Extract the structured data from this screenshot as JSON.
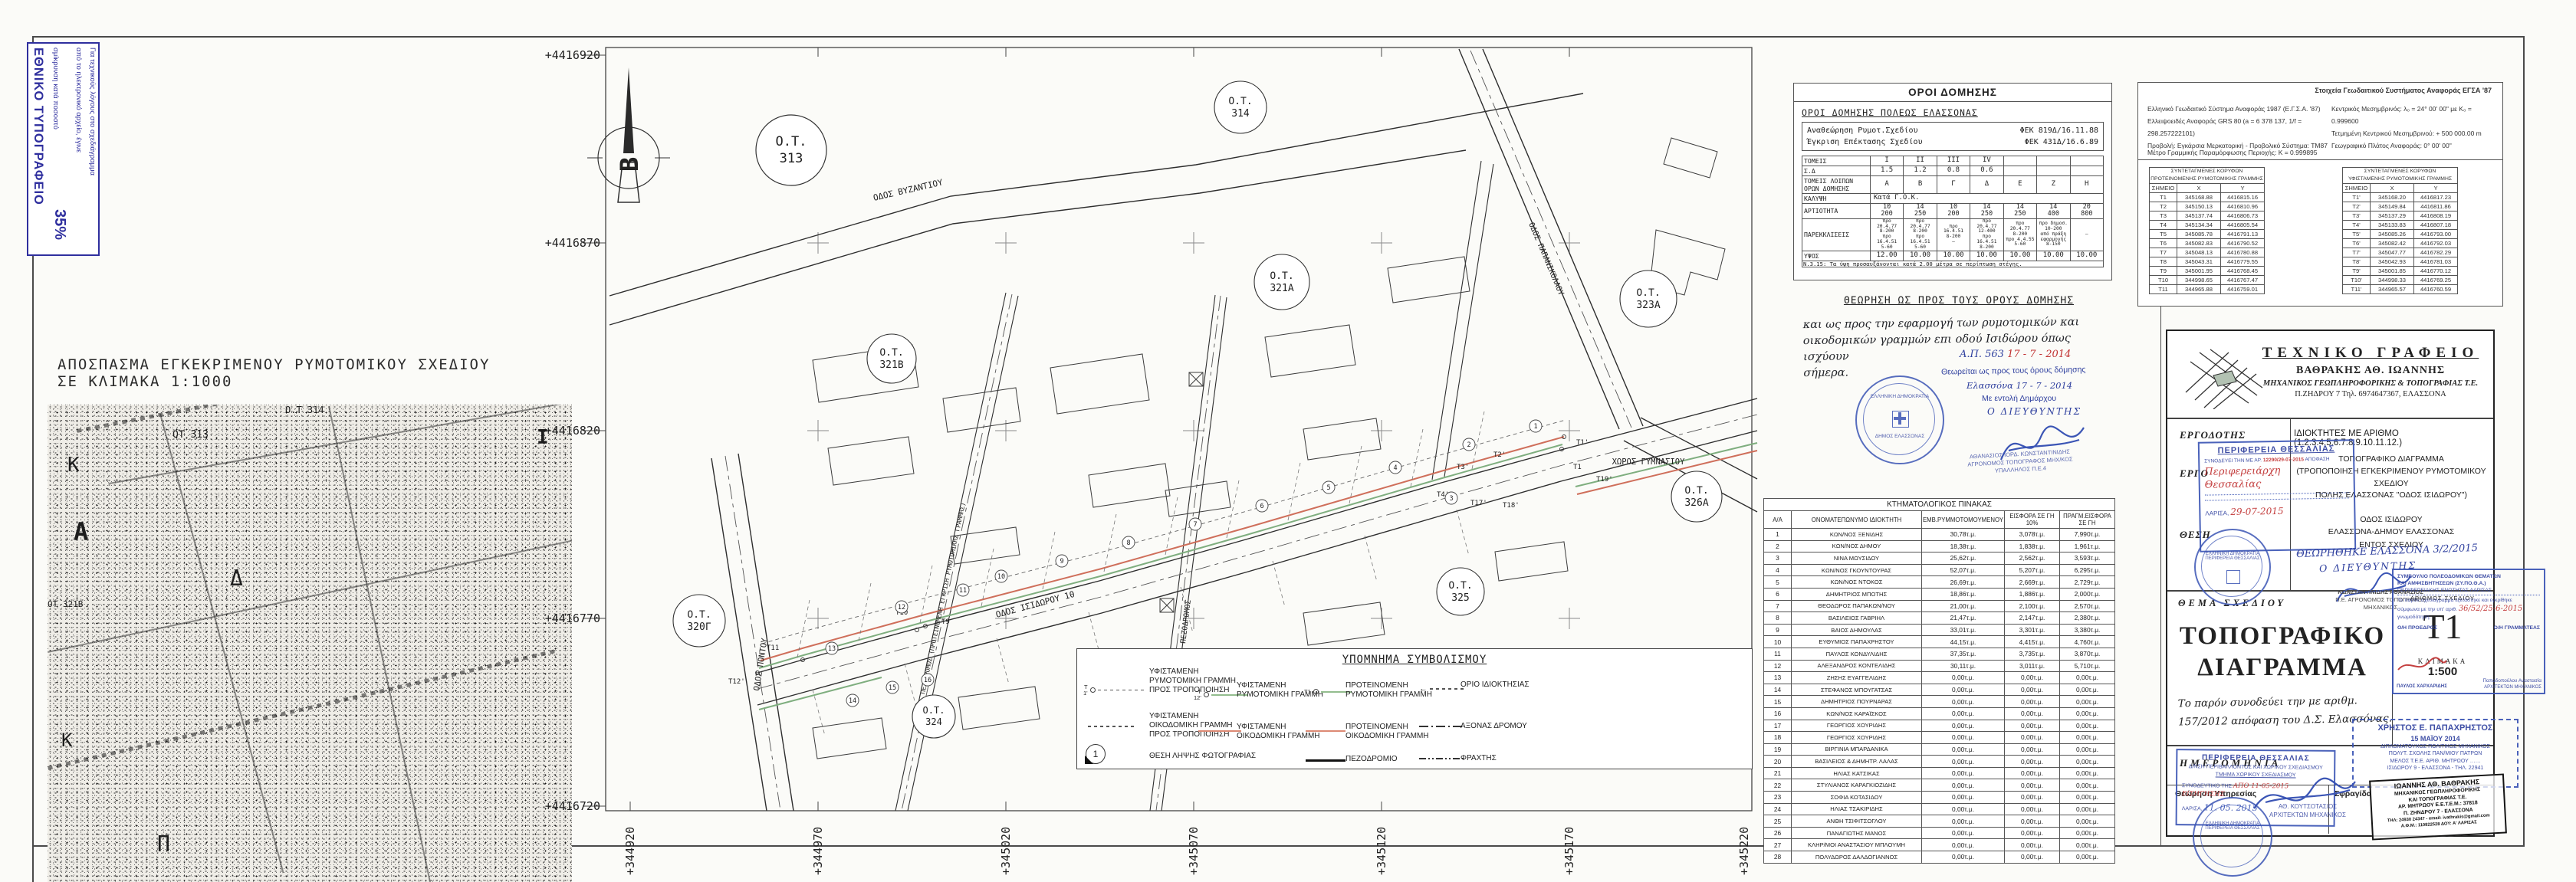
{
  "print_stamp": {
    "title": "ΕΘΝΙΚΟ ΤΥΠΟΓΡΑΦΕΙΟ",
    "line1": "Για τεχνικούς λόγους στο σχεδιάγραμμα",
    "line2": "από το ηλεκτρονικό αρχείο, έγινε",
    "line3": "σμίκρυνση κατά ποσοστό",
    "percent": "35%"
  },
  "excerpt": {
    "title": "ΑΠΟΣΠΑΣΜΑ ΕΓΚΕΚΡΙΜΕΝΟΥ ΡΥΜΟΤΟΜΙΚΟΥ ΣΧΕΔΙΟΥ",
    "subtitle": "ΣΕ ΚΛΙΜΑΚΑ 1:1000",
    "labels": [
      "ΟΤ 313",
      "Ο.Τ 314",
      "ΟΤ 321Β",
      "Κ",
      "Α",
      "Δ",
      "Κ",
      "Π",
      "Ι"
    ]
  },
  "plan": {
    "north": "Β",
    "y_labels": [
      "+4416920",
      "+4416870",
      "+4416820",
      "+4416770",
      "+4416720"
    ],
    "x_labels": [
      "+344920",
      "+344970",
      "+345020",
      "+345070",
      "+345120",
      "+345170",
      "+345220"
    ],
    "blocks": [
      {
        "l1": "Ο.Τ.",
        "l2": "313"
      },
      {
        "l1": "Ο.Τ.",
        "l2": "314"
      },
      {
        "l1": "Ο.Τ.",
        "l2": "321Α"
      },
      {
        "l1": "Ο.Τ.",
        "l2": "321Β"
      },
      {
        "l1": "Ο.Τ.",
        "l2": "323Α"
      },
      {
        "l1": "Ο.Τ.",
        "l2": "326Α"
      },
      {
        "l1": "Ο.Τ.",
        "l2": "320Γ"
      },
      {
        "l1": "Ο.Τ.",
        "l2": "325"
      },
      {
        "l1": "Ο.Τ.",
        "l2": "324"
      }
    ],
    "streets": {
      "vyzantiou": "ΟΔΟΣ ΒΥΖΑΝΤΙΟΥ",
      "isidorou": "ΟΔΟΣ ΙΣΙΔΩΡΟΥ 10",
      "pontou": "ΟΔΟΣ ΠΟΝΤΟΥ",
      "papanikolaou": "ΟΔΟΣ ΠΑΠΑΝΙΚΟΛΑΟΥ",
      "pezodromos": "ΠΕΖΟΔΡΟΜΟΣ",
      "pezodromos_long": "ΠΕΖΟΔΡΟΜΟΣ (ΠΡΟΤΕΙΝΟΜΕΝΗ ΕΓΚΡΙΣΗ ΡΥΜΟΤΟΜΙΚΗΣ ΓΡΑΜΜΗΣ)",
      "gymnasiou": "ΧΩΡΟΣ ΓΥΜΝΑΣΙΟΥ"
    },
    "points": [
      "Τ1",
      "Τ1'",
      "Τ2'",
      "Τ3'",
      "Τ4'",
      "Τ9",
      "Τ10",
      "Τ11",
      "Τ12'",
      "Τ17'",
      "Τ18'",
      "Τ19'"
    ],
    "parcels": [
      "1",
      "2",
      "3",
      "4",
      "5",
      "6",
      "7",
      "8",
      "9",
      "10",
      "11",
      "12",
      "13",
      "14",
      "15",
      "16"
    ]
  },
  "legend": {
    "title": "ΥΠΟΜΝΗΜΑ ΣΥΜΒΟΛΙΣΜΟΥ",
    "items": [
      {
        "pre": "Τ\n1'",
        "label": "ΥΦΙΣΤΑΜΕΝΗ\nΡΥΜΟΤΟΜΙΚΗ ΓΡΑΜΜΗ\nΠΡΟΣ ΤΡΟΠΟΠΟΙΗΣΗ"
      },
      {
        "label": "ΥΦΙΣΤΑΜΕΝΗ\nΟΙΚΟΔΟΜΙΚΗ ΓΡΑΜΜΗ\nΠΡΟΣ ΤΡΟΠΟΠΟΙΗΣΗ"
      },
      {
        "badge": "1",
        "label": "ΘΕΣΗ ΛΗΨΗΣ ΦΩΤΟΓΡΑΦΙΑΣ"
      },
      {
        "pre": "Τ\n12'",
        "label": "ΥΦΙΣΤΑΜΕΝΗ\nΡΥΜΟΤΟΜΙΚΗ ΓΡΑΜΜΗ"
      },
      {
        "label": "ΥΦΙΣΤΑΜΕΝΗ\nΟΙΚΟΔΟΜΙΚΗ ΓΡΑΜΜΗ"
      },
      {
        "pre": "Τ1",
        "label": "ΠΡΟΤΕΙΝΟΜΕΝΗ\nΡΥΜΟΤΟΜΙΚΗ ΓΡΑΜΜΗ"
      },
      {
        "label": "ΠΡΟΤΕΙΝΟΜΕΝΗ\nΟΙΚΟΔΟΜΙΚΗ ΓΡΑΜΜΗ"
      },
      {
        "label": "ΠΕΖΟΔΡΟΜΙΟ"
      },
      {
        "label": "ΟΡΙΟ ΙΔΙΟΚΤΗΣΙΑΣ"
      },
      {
        "label": "ΑΞΟΝΑΣ ΔΡΟΜΟΥ"
      },
      {
        "label": "ΦΡΑΧΤΗΣ"
      }
    ]
  },
  "terms": {
    "box_title": "ΟΡΟΙ ΔΟΜΗΣΗΣ",
    "subtitle": "ΟΡΟΙ ΔΟΜΗΣΗΣ ΠΟΛΕΩΣ ΕΛΑΣΣΟΝΑΣ",
    "fek": [
      {
        "label": "Αναθεώρηση Ρυμοτ.Σχεδίου",
        "value": "ΦΕΚ 819Δ/16.11.88"
      },
      {
        "label": "Έγκριση Επέκτασης Σχεδίου",
        "value": "ΦΕΚ 431Δ/16.6.89"
      }
    ],
    "kalypsi_label": "ΚΑΛΥΨΗ",
    "kalypsi_value": "Κατά Γ.Ο.Κ.",
    "table": {
      "rows": [
        {
          "label": "ΤΟΜΕΙΣ",
          "values": [
            "Ι",
            "ΙΙ",
            "ΙΙΙ",
            "ΙV",
            "",
            "",
            ""
          ]
        },
        {
          "label": "Σ.Δ",
          "values": [
            "1.5",
            "1.2",
            "0.8",
            "0.6",
            "",
            "",
            ""
          ]
        },
        {
          "label": "ΤΟΜΕΙΣ ΛΟΙΠΩΝ\nΟΡΩΝ ΔΟΜΗΣΗΣ",
          "values": [
            "Α",
            "Β",
            "Γ",
            "Δ",
            "Ε",
            "Ζ",
            "Η"
          ]
        },
        {
          "label": "ΑΡΤΙΟΤΗΤΑ",
          "values": [
            "10\n200",
            "14\n250",
            "10\n200",
            "14\n250",
            "14\n250",
            "14\n400",
            "20\n800"
          ]
        },
        {
          "label": "ΠΑΡΕΚΚΛΙΣΕΙΣ",
          "values": [
            "προ 20.4.77\n8-200\nπρο 16.4.51\n5-60",
            "προ 20.4.77\n8-200\nπρο 16.4.51\n5-60",
            "προ 16.4.51\n8-200\n–",
            "προ 20.4.77\n12-400\nπρο 16.4.51\n8-200",
            "προ 20.4.77\n8-200\nπρο 4.4.55\n5-60",
            "προ δημοσ.\n10-200\nαπό πράξη εφαρμογής\n8-150",
            "–"
          ]
        },
        {
          "label": "ΥΨΟΣ",
          "values": [
            "12.00",
            "10.00",
            "10.00",
            "10.00",
            "10.00",
            "10.00",
            "10.00"
          ]
        }
      ]
    },
    "footnote": "Ν.3.15: Τα ύψη προσαυξάνονται κατά 2.00 μέτρα σε περίπτωση στέγης."
  },
  "geo": {
    "title": "Στοιχεία Γεωδαιτικού Συστήματος Αναφοράς ΕΓΣΑ '87",
    "left": [
      "Ελληνικό Γεωδαιτικό Σύστημα Αναφοράς 1987 (Ε.Γ.Σ.Α. '87)",
      "Ελλειψοειδές Αναφοράς GRS 80 (a = 6 378 137, 1/f = 298.257222101)",
      "Προβολή: Εγκάρσια Μερκατορική - Προβολικό Σύστημα: ΤΜ87"
    ],
    "right": [
      "Κεντρικός Μεσημβρινός: λ₀ = 24° 00' 00\" με Κ₀ = 0.999600",
      "Τετμημένη Κεντρικού Μεσημβρινού: + 500 000.00 m",
      "Γεωγραφικό Πλάτος Αναφοράς: 0° 00' 00\""
    ],
    "metro": "Μέτρο Γραμμικής Παραμόρφωσης Περιοχής: Κ = 0.999895"
  },
  "coords": {
    "a": {
      "t1": "ΣΥΝΤΕΤΑΓΜΕΝΕΣ ΚΟΡΥΦΩΝ",
      "t2": "ΠΡΟΤΕΙΝΟΜΕΝΗΣ ΡΥΜΟΤΟΜΙΚΗΣ ΓΡΑΜΜΗΣ",
      "headers": [
        "ΣΗΜΕΙΟ",
        "Χ",
        "Υ"
      ],
      "rows": [
        [
          "Τ1",
          "345168.88",
          "4416815.16"
        ],
        [
          "Τ2",
          "345150.13",
          "4416810.96"
        ],
        [
          "Τ3",
          "345137.74",
          "4416806.73"
        ],
        [
          "Τ4",
          "345134.34",
          "4416805.54"
        ],
        [
          "Τ5",
          "345085.78",
          "4416791.13"
        ],
        [
          "Τ6",
          "345082.83",
          "4416790.52"
        ],
        [
          "Τ7",
          "345048.13",
          "4416780.88"
        ],
        [
          "Τ8",
          "345043.31",
          "4416779.55"
        ],
        [
          "Τ9",
          "345001.95",
          "4416768.45"
        ],
        [
          "Τ10",
          "344998.65",
          "4416767.47"
        ],
        [
          "Τ11",
          "344965.88",
          "4416759.01"
        ]
      ]
    },
    "b": {
      "t1": "ΣΥΝΤΕΤΑΓΜΕΝΕΣ ΚΟΡΥΦΩΝ",
      "t2": "ΥΦΙΣΤΑΜΕΝΗΣ ΡΥΜΟΤΟΜΙΚΗΣ ΓΡΑΜΜΗΣ",
      "headers": [
        "ΣΗΜΕΙΟ",
        "Χ",
        "Υ"
      ],
      "rows": [
        [
          "Τ1'",
          "345168.20",
          "4416817.23"
        ],
        [
          "Τ2'",
          "345149.84",
          "4416811.86"
        ],
        [
          "Τ3'",
          "345137.29",
          "4416808.19"
        ],
        [
          "Τ4'",
          "345133.83",
          "4416807.18"
        ],
        [
          "Τ5'",
          "345085.26",
          "4416793.00"
        ],
        [
          "Τ6'",
          "345082.42",
          "4416792.03"
        ],
        [
          "Τ7'",
          "345047.77",
          "4416782.29"
        ],
        [
          "Τ8'",
          "345042.93",
          "4416781.03"
        ],
        [
          "Τ9'",
          "345001.85",
          "4416770.12"
        ],
        [
          "Τ10'",
          "344998.33",
          "4416769.25"
        ],
        [
          "Τ11'",
          "344965.57",
          "4416760.59"
        ]
      ]
    }
  },
  "theorisi": {
    "title": "ΘΕΩΡΗΣΗ  ΩΣ ΠΡΟΣ ΤΟΥΣ ΟΡΟΥΣ ΔΟΜΗΣΗΣ",
    "note": "και ως προς την εφαρμογή των ρυμοτομικών και\nοικοδομικών γραμμών επι οδού Ισιδώρου όπως ισχύουν\nσήμερα.",
    "ap": "Α.Π. 563",
    "ap_date": "17 - 7 - 2014",
    "line1": "Θεωρείται ως προς τους όρους δόμησης",
    "line2": "Ελασσόνα 17 - 7 - 2014",
    "line3": "Με εντολή Δημάρχου",
    "line4": "Ο ΔΙΕΥΘΥΝΤΗΣ",
    "stamp_line1": "ΕΛΛΗΝΙΚΗ ΔΗΜΟΚΡΑΤΙΑ",
    "stamp_line2": "ΔΗΜΟΣ ΕΛΑΣΣΟΝΑΣ",
    "officer1": "ΑΘΑΝΑΣΙΟΣ ΙΟΡΔ. ΚΩΝΣΤΑΝΤΙΝΙΔΗΣ",
    "officer2": "ΑΓΡΟΝΟΜΟΣ ΤΟΠΟΓΡΑΦΟΣ ΜΗΧ/ΚΟΣ",
    "officer3": "ΥΠΑΛΛΗΛΟΣ Π.Ε.4"
  },
  "cadastral": {
    "title": "ΚΤΗΜΑΤΟΛΟΓΙΚΟΣ ΠΙΝΑΚΑΣ",
    "headers": [
      "Α/Α",
      "ΟΝΟΜΑΤΕΠΩΝΥΜΟ ΙΔΙΟΚΤΗΤΗ",
      "ΕΜΒ.ΡΥΜΜΟΤΟΜΟΥΜΕΝΟΥ",
      "ΕΙΣΦΟΡΑ ΣΕ ΓΗ 10%",
      "ΠΡΑΓΜ.ΕΙΣΦΟΡΑ ΣΕ ΓΗ"
    ],
    "rows": [
      [
        "1",
        "ΚΩΝ/ΝΟΣ ΞΕΝΙΔΗΣ",
        "30,78τ.μ.",
        "3,078τ.μ.",
        "7,990τ.μ."
      ],
      [
        "2",
        "ΚΩΝ/ΝΟΣ ΔΗΜΟΥ",
        "18,38τ.μ.",
        "1,838τ.μ.",
        "1,961τ.μ."
      ],
      [
        "3",
        "ΝΙΝΑ ΜΩΥΣΙΔΟΥ",
        "25,62τ.μ.",
        "2,562τ.μ.",
        "3,593τ.μ."
      ],
      [
        "4",
        "ΚΩΝ/ΝΟΣ ΓΚΟΥΝΤΟΥΡΑΣ",
        "52,07τ.μ.",
        "5,207τ.μ.",
        "6,295τ.μ."
      ],
      [
        "5",
        "ΚΩΝ/ΝΟΣ ΝΤΟΚΟΣ",
        "26,69τ.μ.",
        "2,669τ.μ.",
        "2,729τ.μ."
      ],
      [
        "6",
        "ΔΗΜΗΤΡΙΟΣ ΜΠΟΤΗΣ",
        "18,86τ.μ.",
        "1,886τ.μ.",
        "2,000τ.μ."
      ],
      [
        "7",
        "ΘΕΟΔΩΡΟΣ ΠΑΠΑΚΩΝ/ΝΟΥ",
        "21,00τ.μ.",
        "2,100τ.μ.",
        "2,570τ.μ."
      ],
      [
        "8",
        "ΒΑΣΙΛΕΙΟΣ ΓΑΒΡΙΗΛ",
        "21,47τ.μ.",
        "2,147τ.μ.",
        "2,380τ.μ."
      ],
      [
        "9",
        "ΒΑΙΟΣ ΔΗΜΟΥΛΑΣ",
        "33,01τ.μ.",
        "3,301τ.μ.",
        "3,380τ.μ."
      ],
      [
        "10",
        "ΕΥΘΥΜΙΟΣ ΠΑΠΑΧΡΗΣΤΟΥ",
        "44,15τ.μ.",
        "4,415τ.μ.",
        "4,760τ.μ."
      ],
      [
        "11",
        "ΠΑΥΛΟΣ ΚΟΝΔΥΛΙΔΗΣ",
        "37,35τ.μ.",
        "3,735τ.μ.",
        "3,870τ.μ."
      ],
      [
        "12",
        "ΑΛΕΞΑΝΔΡΟΣ ΚΟΝΤΕΛΙΔΗΣ",
        "30,11τ.μ.",
        "3,011τ.μ.",
        "5,710τ.μ."
      ],
      [
        "13",
        "ΖΗΣΗΣ ΕΥΑΓΓΕΛΙΔΗΣ",
        "0,00τ.μ.",
        "0,00τ.μ.",
        "0,00τ.μ."
      ],
      [
        "14",
        "ΣΤΕΦΑΝΟΣ ΜΠΟΥΓΑΤΣΑΣ",
        "0,00τ.μ.",
        "0,00τ.μ.",
        "0,00τ.μ."
      ],
      [
        "15",
        "ΔΗΜΗΤΡΙΟΣ ΠΟΥΡΝΑΡΑΣ",
        "0,00τ.μ.",
        "0,00τ.μ.",
        "0,00τ.μ."
      ],
      [
        "16",
        "ΚΩΝ/ΝΟΣ ΚΑΡΑΪΣΚΟΣ",
        "0,00τ.μ.",
        "0,00τ.μ.",
        "0,00τ.μ."
      ],
      [
        "17",
        "ΓΕΩΡΓΙΟΣ ΧΟΥΡΙΔΗΣ",
        "0,00τ.μ.",
        "0,00τ.μ.",
        "0,00τ.μ."
      ],
      [
        "18",
        "ΓΕΩΡΓΙΟΣ ΧΟΥΡΙΔΗΣ",
        "0,00τ.μ.",
        "0,00τ.μ.",
        "0,00τ.μ."
      ],
      [
        "19",
        "ΒΙΡΓΙΝΙΑ ΜΠΑΡΔΑΝΙΚΑ",
        "0,00τ.μ.",
        "0,00τ.μ.",
        "0,00τ.μ."
      ],
      [
        "20",
        "ΒΑΣΙΛΕΙΟΣ & ΔΗΜΗΤΡ. ΛΑΛΑΣ",
        "0,00τ.μ.",
        "0,00τ.μ.",
        "0,00τ.μ."
      ],
      [
        "21",
        "ΗΛΙΑΣ ΚΑΤΣΙΚΑΣ",
        "0,00τ.μ.",
        "0,00τ.μ.",
        "0,00τ.μ."
      ],
      [
        "22",
        "ΣΤΥΛΙΑΝΟΣ ΚΑΡΑΓΚΙΟΖΙΔΗΣ",
        "0,00τ.μ.",
        "0,00τ.μ.",
        "0,00τ.μ."
      ],
      [
        "23",
        "ΣΟΦΙΑ ΚΟΤΑΣΙΔΟΥ",
        "0,00τ.μ.",
        "0,00τ.μ.",
        "0,00τ.μ."
      ],
      [
        "24",
        "ΗΛΙΑΣ ΤΣΑΚΙΡΙΔΗΣ",
        "0,00τ.μ.",
        "0,00τ.μ.",
        "0,00τ.μ."
      ],
      [
        "25",
        "ΑΝΘΗ ΤΣΙΦΙΤΣΟΓΛΟΥ",
        "0,00τ.μ.",
        "0,00τ.μ.",
        "0,00τ.μ."
      ],
      [
        "26",
        "ΠΑΝΑΓΙΩΤΗΣ ΜΑΝΟΣ",
        "0,00τ.μ.",
        "0,00τ.μ.",
        "0,00τ.μ."
      ],
      [
        "27",
        "ΚΛΗΡ/ΜΟΙ ΑΝΑΣΤΑΣΙΟΥ ΜΠΛΟΥΜΗ",
        "0,00τ.μ.",
        "0,00τ.μ.",
        "0,00τ.μ."
      ],
      [
        "28",
        "ΠΟΛΥΔΩΡΟΣ ΔΑΛΔΟΓΙΑΝΝΟΣ",
        "0,00τ.μ.",
        "0,00τ.μ.",
        "0,00τ.μ."
      ]
    ]
  },
  "titleblock": {
    "office_title": "ΤΕΧΝΙΚΟ ΓΡΑΦΕΙΟ",
    "office_name": "ΒΑΘΡΑΚΗΣ ΑΘ. ΙΩΑΝΝΗΣ",
    "office_prof": "ΜΗΧΑΝΙΚΟΣ ΓΕΩΠΛΗΡΟΦΟΡΙΚΗΣ & ΤΟΠΟΓΡΑΦΙΑΣ Τ.Ε.",
    "office_addr": "Π.ΖΗΔΡΟΥ 7    Τηλ. 6974647367, ΕΛΑΣΣΟΝΑ",
    "ergodotis_label": "ΕΡΓΟΔΟΤΗΣ",
    "ergodotis_value": "ΙΔΙΟΚΤΗΤΕΣ  ΜΕ ΑΡΙΘΜΟ (1.2.3.4.5.6.7.8.9.10.11.12.)",
    "ergo_label": "ΕΡΓΟ",
    "ergo_l1": "ΤΟΠΟΓΡΑΦΙΚΟ ΔΙΑΓΡΑΜΜΑ",
    "ergo_l2": "(ΤΡΟΠΟΠΟΙΗΣΗ ΕΓΚΕΚΡΙΜΕΝΟΥ ΡΥΜΟΤΟΜΙΚΟΥ ΣΧΕΔΙΟΥ",
    "ergo_l3": "ΠΟΛΗΣ ΕΛΑΣΣΟΝΑΣ \"ΟΔΟΣ ΙΣΙΔΩΡΟΥ\")",
    "thesi_label": "ΘΕΣΗ",
    "thesi_l1": "ΟΔΟΣ ΙΣΙΔΩΡΟΥ",
    "thesi_l2": "ΕΛΑΣΣΟΝΑ-ΔΗΜΟΥ ΕΛΑΣΣΟΝΑΣ",
    "thesi_l3": "ΕΝΤΟΣ ΣΧΕΔΙΟΥ",
    "thema_label": "ΘΕΜΑ ΣΧΕΔΙΟΥ",
    "thema_l1": "ΤΟΠΟΓΡΑΦΙΚΟ",
    "thema_l2": "ΔΙΑΓΡΑΜΜΑ",
    "thema_note": "Το παρόν συνοδεύει την με αριθμ.\n157/2012 απόφαση του Δ.Σ. Ελασσόνας.",
    "arithmos_label": "ΑΡΙΘΜΟΣ ΣΧΕΔΙΟΥ",
    "sheet_no": "Τ1",
    "klimaka_label": "ΚΛΙΜΑΚΑ",
    "scale": "1:500",
    "imerominia_label": "ΗΜΕΡΟΜΗΝΙΑ",
    "theorisi_label": "Θεώρηση Υπηρεσίας",
    "sfragida_label": "Σφραγίδα"
  },
  "stamps": {
    "perifereia": {
      "line1": "ΠΕΡΙΦΕΡΕΙΑ ΘΕΣΣΑΛΙΑΣ",
      "line2": "ΣΥΝΟΔΕΥΕΙ ΤΗΝ ΜΕ ΑΡ.",
      "num": "12290/29-07-2015",
      "line3": "ΑΠΟΦΑΣΗ",
      "script": "Περιφερειάρχη\nΘεσσαλίας",
      "city": "ΛΑΡΙΣΑ,",
      "date": "29-07-2015"
    },
    "theorithike": {
      "line1": "ΘΕΩΡΗΘΗΚΕ ΕΛΑΣΣΟΝΑ 3/2/2015",
      "line2": "Ο ΔΙΕΥΘΥΝΤΗΣ",
      "name": "ΚΩΝΣΤΑΝΤΙΝΙΔΗΣ ΑΘΑΝΑΣΙΟΣ",
      "title": "Π.Ε. ΑΓΡΟΝΟΜΟΣ ΤΟΠΟΓΡΑΦΟΣ\nΜΗΧΑΝΙΚΟΣ"
    },
    "sypotha": {
      "line1": "ΣΥΜΒΟΥΛΙΟ ΠΟΛΕΟΔΟΜΙΚΩΝ ΘΕΜΑΤΩΝ",
      "line2": "ΚΑΙ ΑΜΦΙΣΒΗΤΗΣΕΩΝ (ΣΥ.ΠΟ.Θ.Α.)",
      "line3": "ΠΕΡΙΦΕΡΕΙΑΚΗΣ ΕΝΟΤΗΤΑΣ ΛΑΡΙΣΑΣ",
      "body1": "Το παρόν σχεδιάγραμμα εξετάστηκε και εγκρίθηκε",
      "body2": "σύμφωνα με την υπ' αριθ.",
      "num": "36/52/25-6-2015",
      "body3": "γνωμοδότηση.",
      "proedros": "Ο/Η ΠΡΟΕΔΡΟΣ",
      "grammateas": "Ο/Η ΓΡΑΜΜΑΤΕΑΣ",
      "name1": "ΠΑΥΛΟΣ ΧΑΡΧΑΡΙΔΗΣ",
      "name2": "Παπαδοπούλου Αναστασία",
      "name2b": "ΑΡΧΙΤΕΚΤΩΝ ΜΗΧΑΝΙΚΟΣ"
    },
    "ypiresia": {
      "line1": "ΠΕΡΙΦΕΡΕΙΑ ΘΕΣΣΑΛΙΑΣ",
      "line2": "Δ/ΝΣΗ ΠΕΡΙΒΑΛΛΟΝΤΟΣ ΚΑΙ ΧΩΡΙΚΟΥ ΣΧΕΔΙΑΣΜΟΥ",
      "line3": "ΤΜΗΜΑ ΧΩΡΙΚΟΥ ΣΧΕΔΙΑΣΜΟΥ",
      "line4": "ΣΥΝΟΔΕΥΤΙΚΟ ΤΗΣ",
      "red": "ΑΠΟ 11-05-2015 ΕΙΣΗΓΗΣΗΣ",
      "city": "ΛΑΡΙΣΑ,",
      "date": "11. 05. 2015",
      "circle": "ΕΛΛΗΝΙΚΗ ΔΗΜΟΚΡΑΤΙΑ\nΠΕΡΙΦΕΡΕΙΑ ΘΕΣΣΑΛΙΑΣ",
      "name": "ΑΘ. ΚΟΥΤΣΟΤΑΣΙΟΣ",
      "title": "ΑΡΧΙΤΕΚΤΩΝ ΜΗΧΑΝΙΚΟΣ"
    },
    "papachristos": {
      "name": "ΧΡΗΣΤΟΣ Ε. ΠΑΠΑΧΡΗΣΤΟΣ",
      "date": "15 ΜΑΪΟΥ 2014",
      "line1": "ΔΙΠΛΩΜΑΤΟΥΧΟΣ ΠΟΛΙΤΙΚΟΣ ΜΗΧΑΝΙΚΟΣ",
      "line2": "ΠΟΛΥΤ. ΣΧΟΛΗΣ ΠΑΝ/ΜΙΟΥ ΠΑΤΡΩΝ",
      "line3": "ΜΕΛΟΣ Τ.Ε.Ε. ΑΡΙΘ. ΜΗΤΡΩΟΥ ……",
      "line4": "ΙΣΙΔΩΡΟΥ 9 - ΕΛΑΣΣΟΝΑ - ΤΗΛ. 22941"
    },
    "vathrakis": {
      "name": "ΙΩΑΝΝΗΣ ΑΘ. ΒΑΘΡΑΚΗΣ",
      "l1": "ΜΗΧΑΝΙΚΟΣ ΓΕΩΠΛΗΡΟΦΟΡΙΚΗΣ",
      "l2": "ΚΑΙ ΤΟΠΟΓΡΑΦΙΑΣ Τ.Ε.",
      "l3": "ΑΡ. ΜΗΤΡΩΟΥ Ε.Ε.Τ.Ε.Μ.: 37818",
      "l4": "Π. ΖΗΝΔΡΟΥ 7 - ΕΛΑΣΣΟΝΑ",
      "l5": "ΤΗΛ: 24930 24347 - email: ivathrakis@gmail.com",
      "l6": "Α.Φ.Μ.: 110822528 ΔΟΥ: Α' ΛΑΡΙΣΑΣ"
    }
  }
}
